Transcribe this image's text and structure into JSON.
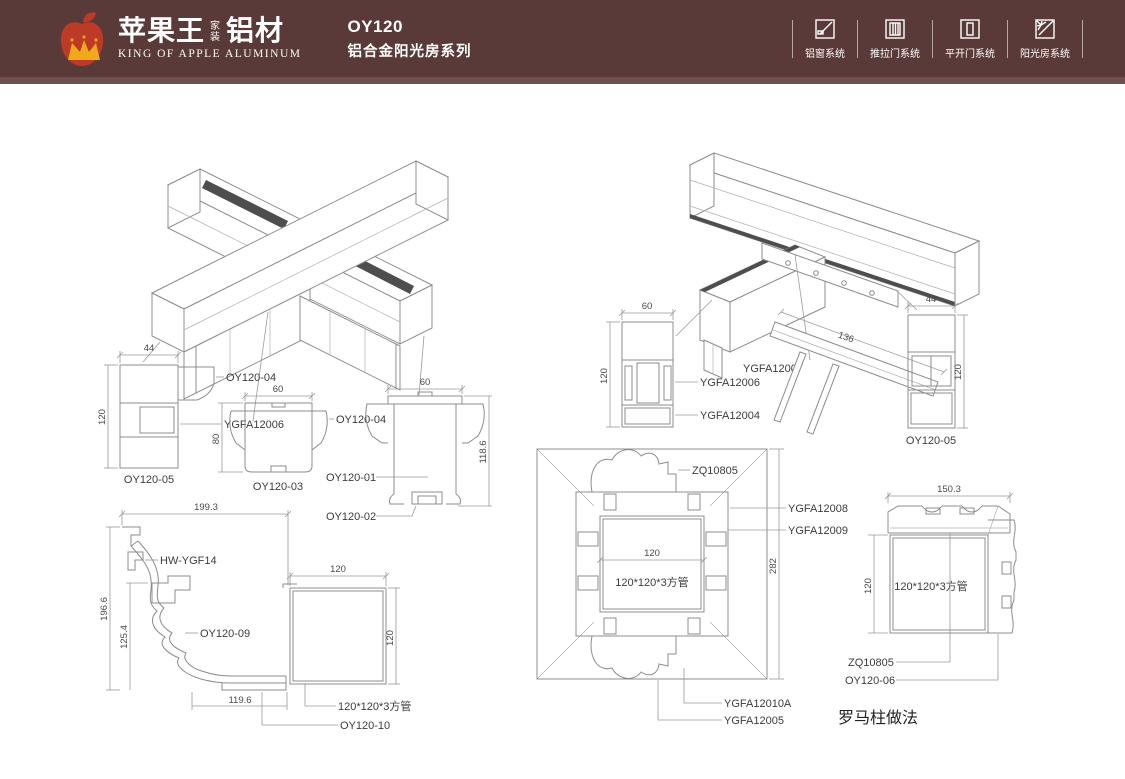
{
  "header": {
    "brand": {
      "cn": "苹果王",
      "tag1": "家",
      "tag2": "装",
      "suffix": "铝材",
      "en": "KING OF APPLE ALUMINUM"
    },
    "title": "OY120",
    "subtitle": "铝合金阳光房系列",
    "systems": [
      {
        "icon": "window-system-icon",
        "label": "铝窗系统"
      },
      {
        "icon": "sliding-door-system-icon",
        "label": "推拉门系统"
      },
      {
        "icon": "casement-door-system-icon",
        "label": "平开门系统"
      },
      {
        "icon": "sunroom-system-icon",
        "label": "阳光房系统"
      }
    ],
    "colors": {
      "bar": "#5a3a38",
      "strip": "#6d504d",
      "apple": "#bc3a26",
      "crown": "#f0a81c",
      "text": "#ffffff"
    }
  },
  "drawings": {
    "detail_a": {
      "dim_w": "44",
      "dim_h": "120",
      "label_bracket": "OY120-04",
      "label_inner": "YGFA12006",
      "caption": "OY120-05"
    },
    "detail_b": {
      "dim_w": "60",
      "dim_h": "80",
      "label_wing": "OY120-04",
      "caption": "OY120-03"
    },
    "detail_c": {
      "dim_w": "60",
      "dim_h": "118.6",
      "label_body": "OY120-01",
      "label_insert": "OY120-02"
    },
    "gutter": {
      "dim_top": "199.3",
      "dim_left": "196.6",
      "dim_inner": "125.4",
      "dim_bottom": "119.6",
      "label_clip": "HW-YGF14",
      "label_body": "OY120-09"
    },
    "tube": {
      "dim_w": "120",
      "dim_h": "120",
      "label": "120*120*3方管",
      "caption": "OY120-10"
    },
    "detail_r1": {
      "dim_w": "60",
      "dim_h": "120",
      "label_mid": "YGFA12006",
      "label_bottom": "YGFA12004"
    },
    "plate": {
      "dim": "136",
      "label": "YGFA12007"
    },
    "detail_r2": {
      "dim_w": "44",
      "dim_h": "120",
      "caption": "OY120-05"
    },
    "column_plan": {
      "label_top": "ZQ10805",
      "label_r1": "YGFA12008",
      "label_r2": "YGFA12009",
      "dim_right": "282",
      "dim_tube": "120",
      "tube_label": "120*120*3方管",
      "label_b1": "YGFA12010A",
      "label_b2": "YGFA12005"
    },
    "corner": {
      "dim_top": "150.3",
      "dim_left": "120",
      "tube_label": "120*120*3方管",
      "label_cap": "ZQ10805",
      "label_side": "OY120-06",
      "caption": "罗马柱做法"
    }
  }
}
